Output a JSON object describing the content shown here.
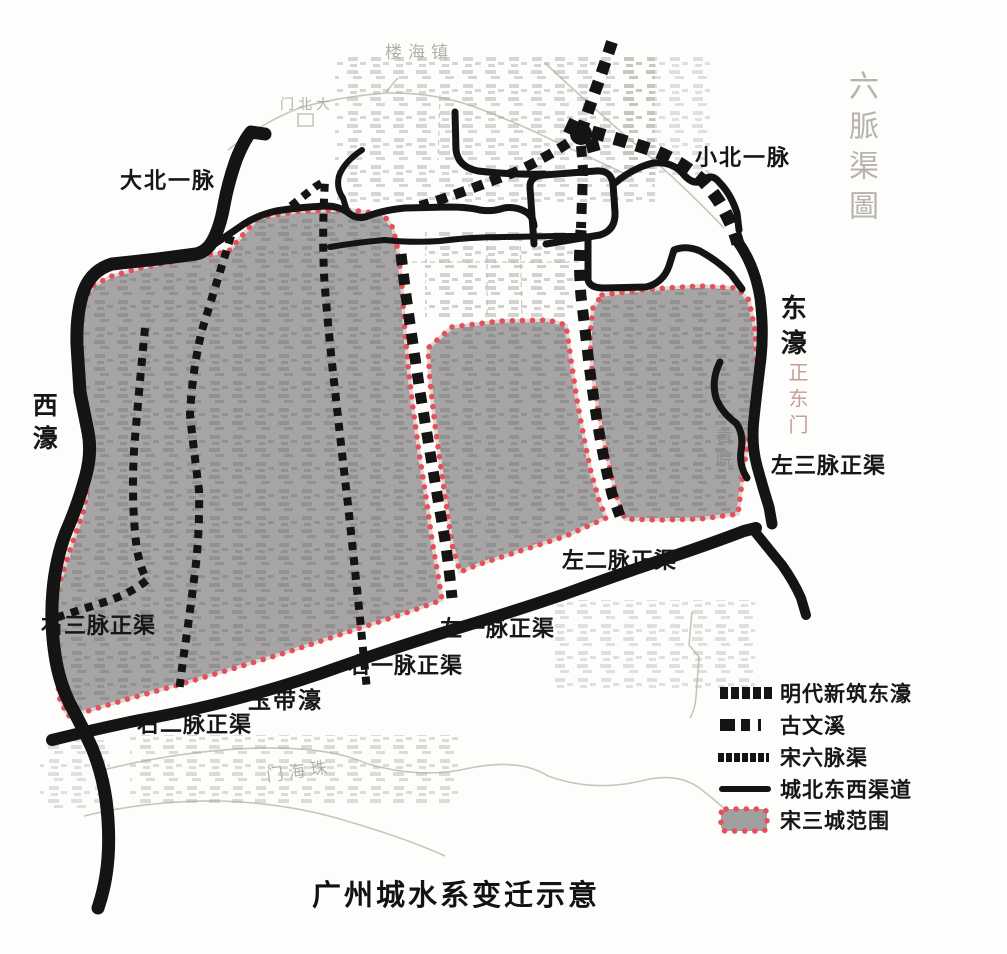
{
  "title": "广州城水系变迁示意",
  "map_labels": {
    "da_bei_yi_mai": {
      "text": "大北一脉"
    },
    "xiao_bei_yi_mai": {
      "text": "小北一脉"
    },
    "xi_hao": {
      "text": "西濠"
    },
    "dong_hao": {
      "text": "东濠"
    },
    "zuo_san_mai": {
      "text": "左三脉正渠"
    },
    "zuo_er_mai": {
      "text": "左二脉正渠"
    },
    "zuo_yi_mai": {
      "text": "左一脉正渠"
    },
    "you_yi_mai": {
      "text": "右一脉正渠"
    },
    "yu_dai_hao": {
      "text": "玉带濠"
    },
    "you_er_mai": {
      "text": "右二脉正渠"
    },
    "you_san_mai": {
      "text": "右三脉正渠"
    }
  },
  "background_labels": {
    "liu_mai_qu_tu": {
      "text": "六脈渠圖",
      "orientation": "vertical"
    },
    "zhen_hai_lou": {
      "text": "楼海镇"
    },
    "da_bei_men": {
      "text": "门北大"
    },
    "zheng_dong_men": {
      "text": "正东门",
      "orientation": "vertical"
    },
    "gong_yuan": {
      "text": "貢院",
      "orientation": "vertical"
    },
    "zhu_hai_men": {
      "text": "门海珠"
    }
  },
  "legend": {
    "items": [
      {
        "label": "明代新筑东濠",
        "marker": "bold-dashed-line"
      },
      {
        "label": "古文溪",
        "marker": "mixed-dashed-line"
      },
      {
        "label": "宋六脉渠",
        "marker": "fine-dashed-line"
      },
      {
        "label": "城北东西渠道",
        "marker": "solid-line"
      },
      {
        "label": "宋三城范围",
        "marker": "gray-area-red-dotted-border"
      }
    ]
  },
  "colors": {
    "line_black": "#141414",
    "song_city_gray": "#a6a4a4",
    "boundary_red": "#e6505a",
    "faint_map_gray": "#c8c4c0"
  }
}
